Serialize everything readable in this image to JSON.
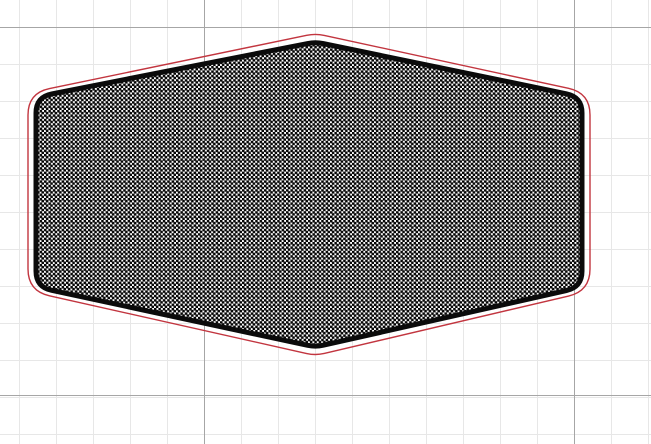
{
  "canvas": {
    "width_px": 651,
    "height_px": 444,
    "background_color": "#ffffff"
  },
  "grid": {
    "minor_color": "#e7e7e7",
    "major_color": "#a6a6a6",
    "minor_spacing_px": 37,
    "minor_offset_x": 19,
    "minor_offset_y": 27,
    "major_spacing_x": 370,
    "major_spacing_y": 368,
    "major_offset_x": 204,
    "major_offset_y": 27
  },
  "shape": {
    "kind": "rounded-hexagon-pocket",
    "fill_pattern": {
      "type": "checker-dot-lattice",
      "dot_color": "#050505",
      "background_color": "#ffffff",
      "pitch_px": 4.4,
      "dot_radius_px": 1.5
    },
    "outline": {
      "color": "#0b0b0b",
      "stroke_width_px": 5,
      "vertices": [
        [
          315.5,
          42
        ],
        [
          582,
          97
        ],
        [
          582,
          287
        ],
        [
          315.5,
          347
        ],
        [
          36,
          287
        ],
        [
          36,
          97
        ]
      ],
      "corner_radii": [
        8,
        16,
        16,
        8,
        16,
        16
      ]
    },
    "offset_outline": {
      "color": "#c2353f",
      "stroke_width_px": 1.4,
      "vertices": [
        [
          315.5,
          33.5
        ],
        [
          590,
          93
        ],
        [
          590,
          291
        ],
        [
          315.5,
          355.5
        ],
        [
          28,
          291
        ],
        [
          28,
          93
        ]
      ],
      "corner_radii": [
        9,
        22,
        22,
        9,
        22,
        22
      ]
    }
  }
}
